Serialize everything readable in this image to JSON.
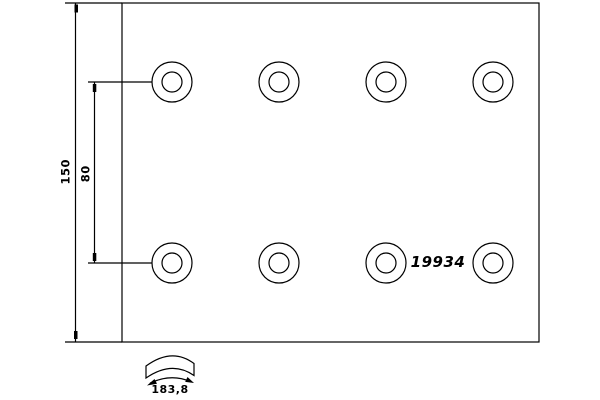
{
  "drawing": {
    "description": "brake-lining-technical-drawing",
    "part_number": "19934",
    "dimensions": {
      "height": "150",
      "hole_spacing": "80",
      "arc_width": "183,8"
    },
    "holes": {
      "rows": 2,
      "per_row": 4
    },
    "colors": {
      "line": "#000000",
      "background": "#ffffff"
    }
  }
}
